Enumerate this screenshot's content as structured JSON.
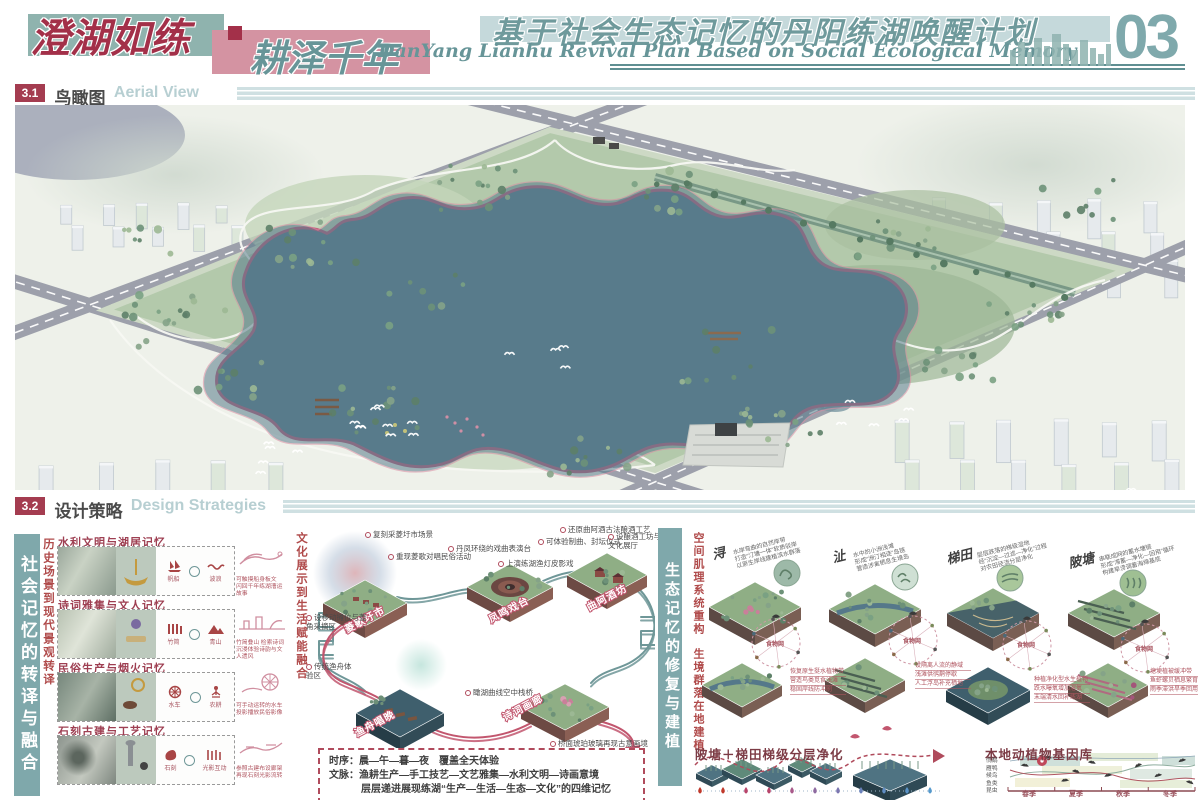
{
  "header": {
    "title_part1": "澄湖如练",
    "divider": "-",
    "title_part2": "耕泽千年",
    "subtitle_cn": "基于社会生态记忆的丹阳练湖唤醒计划",
    "subtitle_en": "DanYang Lianhu Revival Plan Based on Social Ecological Memory",
    "page_number": "03"
  },
  "section_aerial": {
    "number": "3.1",
    "title_cn": "鸟瞰图",
    "title_en": "Aerial View"
  },
  "section_strategy": {
    "number": "3.2",
    "title_cn": "设计策略",
    "title_en": "Design Strategies"
  },
  "left_column": {
    "side_label": "社会记忆的转译与融合",
    "axis_history": "历史场景到现代景观转译",
    "panels": [
      {
        "title": "水利文明与湖居记忆",
        "icon1_label": "帆船",
        "icon2_label": "波浪",
        "note1": "可触摸船身板文",
        "note2": "闪回千年练湖漕运故事"
      },
      {
        "title": "诗词雅集与文人记忆",
        "icon1_label": "竹简",
        "icon2_label": "青山",
        "note1": "竹简叠山 检索诗词",
        "note2": "沉浸体验诗韵与文人遗风"
      },
      {
        "title": "民俗生产与烟火记忆",
        "icon1_label": "水车",
        "icon2_label": "农耕",
        "note1": "可手动运转的水车",
        "note2": "投影播放民俗影像"
      },
      {
        "title": "石刻古建与工艺记忆",
        "icon1_label": "石刻",
        "icon2_label": "光影互动",
        "note1": "参照古建布设廊架",
        "note2": "再现石刻光影流转"
      }
    ]
  },
  "culture_diagram": {
    "side_label": "文化展示到生活赋能融合",
    "stations": {
      "s1": "菱歌圩市",
      "s2": "凤鸣戏台",
      "s3": "曲阿酒坊",
      "s4": "渔舟唱晚",
      "s5": "诗词画廊"
    },
    "annotations": {
      "a1": "复刻采菱圩市场景",
      "a2": "重现菱歌对唱民俗活动",
      "a3": "设移动摊位与菱角采摘区",
      "a4": "丹凤环绕的戏曲表演台",
      "a5": "上演练湖渔灯皮影戏",
      "a6": "还原曲阿酒古法酿酒工艺",
      "a7": "可体验制曲、封坛仪式",
      "a8": "设酿酒工坊与文化展厅",
      "a9": "传统渔舟体验区",
      "a10": "瞰湖曲线空中栈桥",
      "a11": "桥面琥珀玻璃再现古意画境"
    },
    "summary": {
      "timeline_label": "时序：",
      "timeline_text": "晨—午—暮—夜　覆盖全天体验",
      "context_label": "文脉：",
      "context_text": "渔耕生产—手工技艺—文艺雅集—水利文明—诗画意境",
      "context_text2": "层层递进展现练湖“生产—生活—生态—文化”的四维记忆"
    }
  },
  "eco_section": {
    "side_label": "生态记忆的修复与建植",
    "axis_structure": "空间肌理系统重构",
    "axis_habitat": "生境群落在地建植",
    "strategies": [
      {
        "name": "浔",
        "d1": "水岸弯曲的自然岸带",
        "d2": "打造“汀塘一体”软质驳岸",
        "d3": "以原生岸线建植滨水群落",
        "web_label": "食物网",
        "n1": "恢复原生挺水植物带",
        "n2": "营造鸟类觅食浅滩",
        "n3": "稳固岸线防冲刷"
      },
      {
        "name": "沚",
        "d1": "水中的小洲浅滩",
        "d2": "形成“洲汀相连”岛链",
        "d3": "营造涉禽栖息生境岛",
        "web_label": "食物网",
        "n1": "设隔离人流的静域",
        "n2": "浅滩供鸻鹬停歇",
        "n3": "人工浮岛补充栖地"
      },
      {
        "name": "梯田",
        "d1": "层层跌落的梯级湿地",
        "d2": "经“沉淀—过滤—净化”过程",
        "d3": "对农田径流分层净化",
        "web_label": "食物网",
        "n1": "种植净化型水生植物",
        "n2": "跌水曝氧增加溶氧",
        "n3": "末端清水回补练湖"
      },
      {
        "name": "陂塘",
        "d1": "串联成网的蓄水塘链",
        "d2": "形成“滞蓄—净化—回用”循环",
        "d3": "构建旱涝调蓄海绵基底",
        "web_label": "食物网",
        "n1": "塘埂植被缓冲带",
        "n2": "鱼虾螺贝栖息繁育",
        "n3": "雨季滞洪旱季回用"
      }
    ],
    "purification_title": "陂塘＋梯田梯级分层净化",
    "genebank": {
      "title": "本地动植物基因库",
      "rows": [
        "鸻鹬",
        "雁鸭",
        "候鸟",
        "鱼类",
        "昆虫"
      ],
      "seasons": [
        "春季",
        "夏季",
        "秋季",
        "冬季"
      ]
    }
  },
  "colors": {
    "accent_red": "#a43c50",
    "teal": "#6f9a9c",
    "light_blue": "#c5d9db",
    "pink_block": "#d493a2",
    "lake": "#587b8b",
    "path_pink": "#c05d7c"
  }
}
